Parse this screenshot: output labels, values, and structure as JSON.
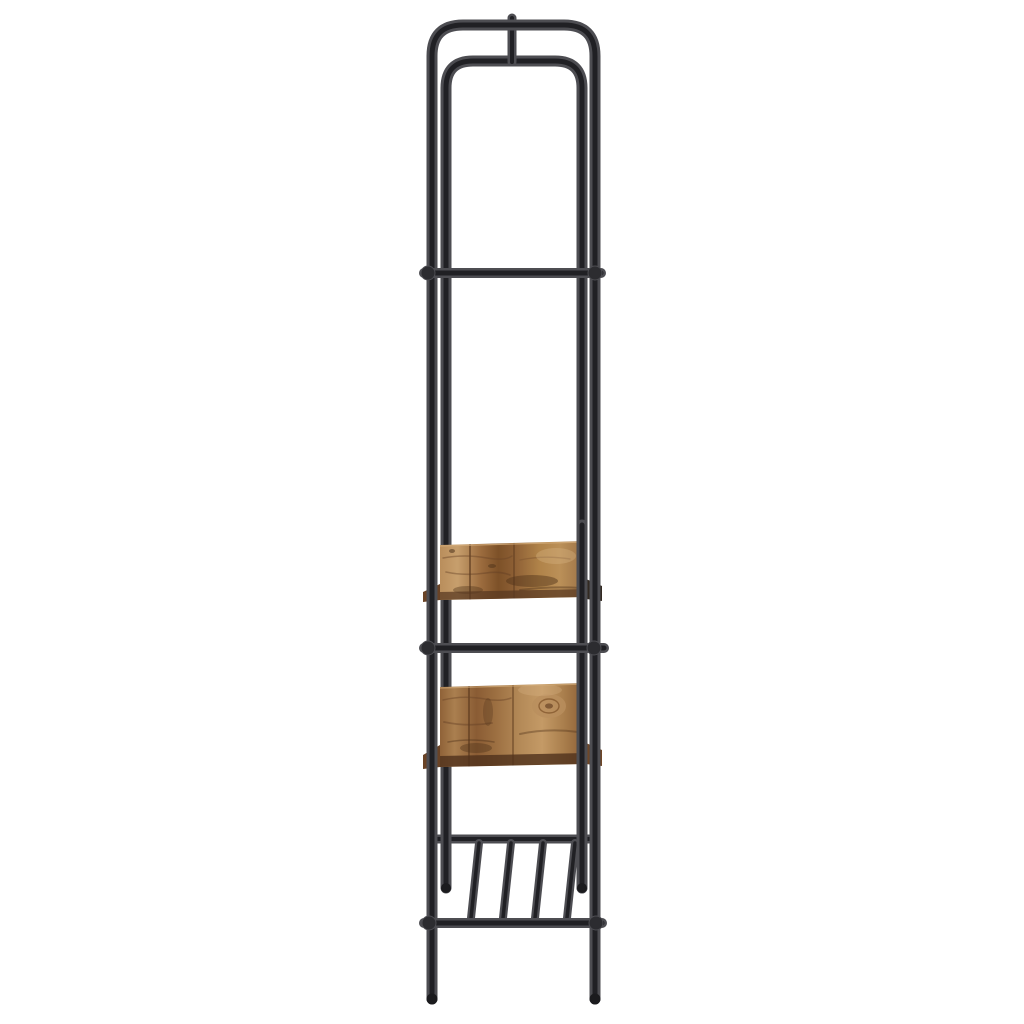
{
  "product_photo": {
    "alt": "Tall narrow clothes rack with shelves, side view, black metal tube frame with rustic brown wooden shelves on white background",
    "background_color": "#ffffff",
    "frame": {
      "material": "round steel tube",
      "color_name": "black / dark charcoal",
      "parts": [
        "outer-arch-frame",
        "inner-arch-frame",
        "top-connector-stub",
        "upper-crossbar",
        "middle-crossbar",
        "upper-wood-shelf",
        "lower-wood-shelf",
        "slatted-bottom-rack",
        "bottom-crossbar",
        "legs-with-feet"
      ],
      "slat_count": 4,
      "leg_count": 2
    },
    "shelves": {
      "count": 2,
      "material": "wood, rustic brown finish"
    },
    "palette": {
      "bg": "#ffffff",
      "frame-edge": "#4d4d52",
      "frame-core": "#202024",
      "wood-light": "#c79f6d",
      "wood-mid": "#9c6c3e",
      "wood-dark": "#6a4326"
    }
  }
}
